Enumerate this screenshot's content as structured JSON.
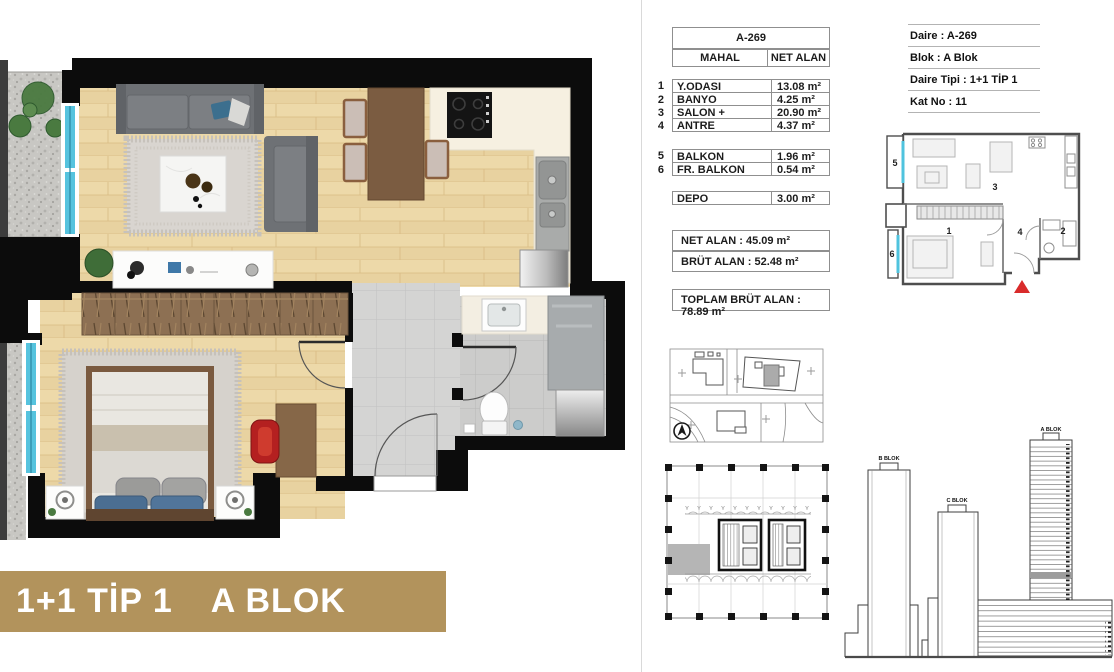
{
  "banner": {
    "type_label": "1+1 TİP 1",
    "block_label": "A BLOK"
  },
  "accent_colors": {
    "banner_gold": "#b2935c",
    "window_cyan": "#56c3de",
    "entry_red": "#d92b2b"
  },
  "area_table": {
    "unit_header": "A-269",
    "col_mahal": "MAHAL",
    "col_net_alan": "NET ALAN",
    "rows": [
      {
        "no": "1",
        "name": "Y.ODASI",
        "value": "13.08 m²"
      },
      {
        "no": "2",
        "name": "BANYO",
        "value": "4.25 m²"
      },
      {
        "no": "3",
        "name": "SALON + MUTFAK",
        "value": "20.90 m²"
      },
      {
        "no": "4",
        "name": "ANTRE",
        "value": "4.37 m²"
      }
    ],
    "balcony_rows": [
      {
        "no": "5",
        "name": "BALKON",
        "value": "1.96 m²"
      },
      {
        "no": "6",
        "name": "FR. BALKON",
        "value": "0.54 m²"
      }
    ],
    "depo_row": {
      "name": "DEPO",
      "value": "3.00 m²"
    },
    "net_alan": "NET ALAN : 45.09 m²",
    "brut_alan": "BRÜT ALAN : 52.48 m²",
    "toplam_brut_alan": "TOPLAM BRÜT ALAN : 78.89 m²"
  },
  "info_panel": {
    "separator": " : ",
    "rows": [
      {
        "label": "Daire",
        "value": "A-269"
      },
      {
        "label": "Blok",
        "value": "A Blok"
      },
      {
        "label": "Daire Tipi",
        "value": "1+1 TİP 1"
      },
      {
        "label": "Kat No",
        "value": "11"
      }
    ]
  },
  "schematic": {
    "room_numbers": {
      "balkon": "5",
      "salon": "3",
      "yatak_odasi": "1",
      "antre": "4",
      "banyo": "2",
      "fr_balkon": "6"
    }
  },
  "elevations": {
    "b_blok": "B BLOK",
    "c_blok": "C BLOK",
    "a_blok": "A BLOK"
  }
}
